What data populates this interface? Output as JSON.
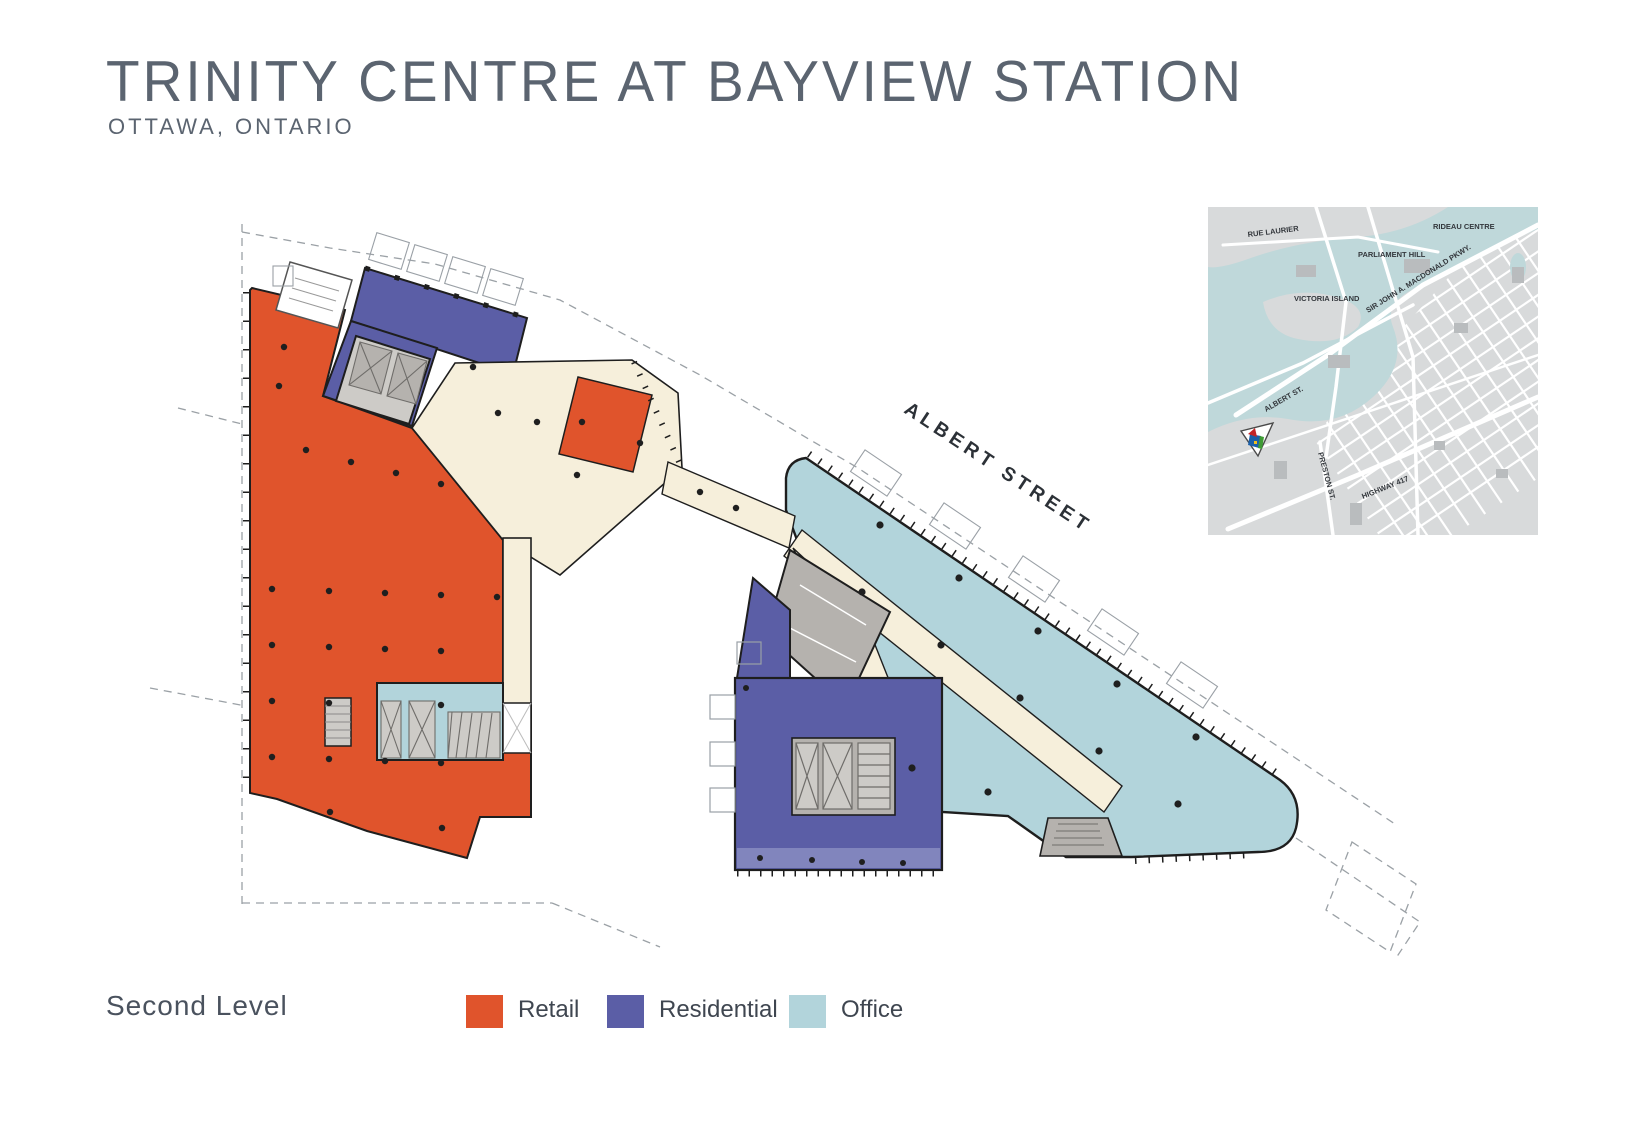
{
  "header": {
    "title": "TRINITY CENTRE AT BAYVIEW STATION",
    "subtitle": "OTTAWA, ONTARIO"
  },
  "plan": {
    "street_label": "ALBERT STREET",
    "level_label": "Second Level"
  },
  "legend": {
    "items": [
      {
        "label": "Retail",
        "color": "#E0542C"
      },
      {
        "label": "Residential",
        "color": "#5B5EA6"
      },
      {
        "label": "Office",
        "color": "#B2D4DB"
      }
    ]
  },
  "colors": {
    "retail": "#E0542C",
    "residential": "#5B5EA6",
    "residential_light": "#8185BD",
    "office": "#B2D4DB",
    "circulation": "#F6EFDB",
    "core": "#B5B2AE",
    "core_light": "#CDCBC7",
    "outline": "#1E1E1E",
    "dashed": "#9BA1A6",
    "title_text": "#5B6470",
    "street_text": "#2C3137",
    "map_land": "#D8DADB",
    "map_water": "#BFD8DA",
    "map_building": "#B9BCBE",
    "map_label": "#33373C"
  },
  "inset_map": {
    "labels": [
      {
        "id": "rue-laurier",
        "text": "RUE LAURIER"
      },
      {
        "id": "rideau-centre",
        "text": "RIDEAU CENTRE"
      },
      {
        "id": "parliament-hill",
        "text": "PARLIAMENT HILL"
      },
      {
        "id": "victoria-island",
        "text": "VICTORIA ISLAND"
      },
      {
        "id": "macdonald-pkwy",
        "text": "SIR JOHN A. MACDONALD PKWY."
      },
      {
        "id": "albert-st",
        "text": "ALBERT ST."
      },
      {
        "id": "preston-st",
        "text": "PRESTON ST."
      },
      {
        "id": "highway-417",
        "text": "HIGHWAY 417"
      }
    ]
  }
}
